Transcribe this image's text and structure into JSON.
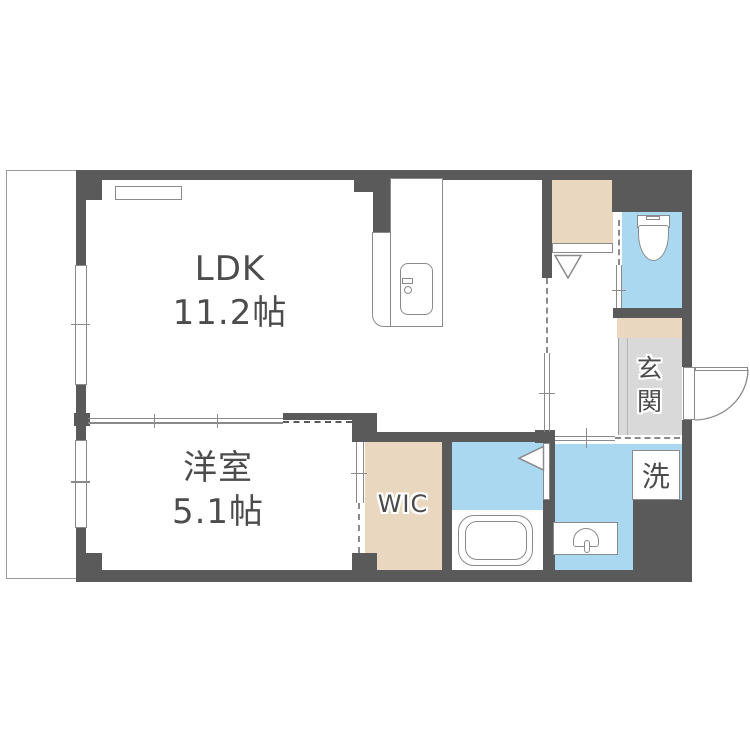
{
  "plan_title": "apartment-floor-plan",
  "rooms": {
    "ldk": {
      "name": "LDK",
      "size": "11.2帖"
    },
    "bedroom": {
      "name": "洋室",
      "size": "5.1帖"
    },
    "wic": {
      "label": "WIC"
    },
    "entrance": {
      "label": "玄関"
    },
    "laundry": {
      "label": "洗"
    }
  },
  "colors": {
    "wall": "#5a5a5a",
    "water_area_blue": "#aad8f0",
    "storage_beige": "#e9d8bf",
    "entrance_floor_gray": "#d9d9d9",
    "fixture_outline": "#8a8a8a",
    "label_text": "#4c4c4c"
  }
}
